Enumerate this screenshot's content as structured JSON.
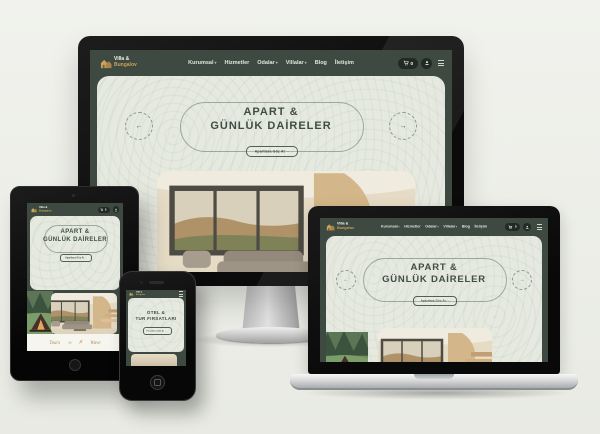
{
  "brand": {
    "line1": "Villa &",
    "line2": "Bungalov"
  },
  "nav": {
    "items": [
      {
        "label": "Kurumsal",
        "caret": "▾"
      },
      {
        "label": "Hizmetler",
        "caret": ""
      },
      {
        "label": "Odalar",
        "caret": "▾"
      },
      {
        "label": "Villalar",
        "caret": "▾"
      },
      {
        "label": "Blog",
        "caret": ""
      },
      {
        "label": "İletişim",
        "caret": ""
      }
    ]
  },
  "header": {
    "cart_count": "0"
  },
  "hero": {
    "line1": "APART &",
    "line2": "GÜNLÜK DAİRELER",
    "cta": "Apartlara Göz At →",
    "prev": "←",
    "next": "→"
  },
  "mobile_hero": {
    "line1": "OTEL &",
    "line2": "TUR FIRSATLARI",
    "cta": "Fırsatlara Göz At →"
  },
  "partners": {
    "logos": [
      "Tours",
      "∞",
      "✗",
      "Wave"
    ]
  },
  "colors": {
    "header_green": "#3e4a41",
    "sage": "#e5e9df",
    "gold": "#c8a25b",
    "ink": "#3f4d42"
  }
}
